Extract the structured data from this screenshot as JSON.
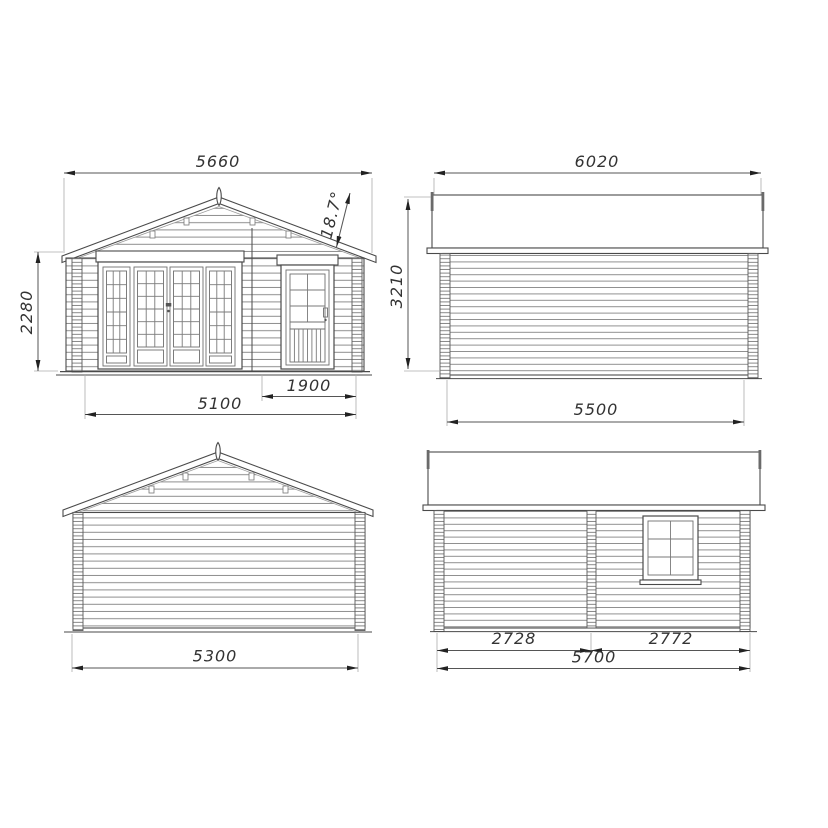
{
  "palette": {
    "background": "#ffffff",
    "outline": "#4a4a4a",
    "siding_line": "#8f8f8f",
    "dimension_line": "#555555",
    "dimension_text": "#333333",
    "arrow": "#222222"
  },
  "views": {
    "front": {
      "roof_width": "5660",
      "wall_height": "2280",
      "roof_pitch": "18.7°",
      "door_bay_width": "1900",
      "main_bay_width": "5100"
    },
    "side_a": {
      "roof_length": "6020",
      "overall_height": "3210",
      "wall_length": "5500"
    },
    "rear": {
      "wall_width": "5300"
    },
    "side_b": {
      "front_bay": "2728",
      "rear_bay": "2772",
      "wall_length": "5700"
    }
  }
}
